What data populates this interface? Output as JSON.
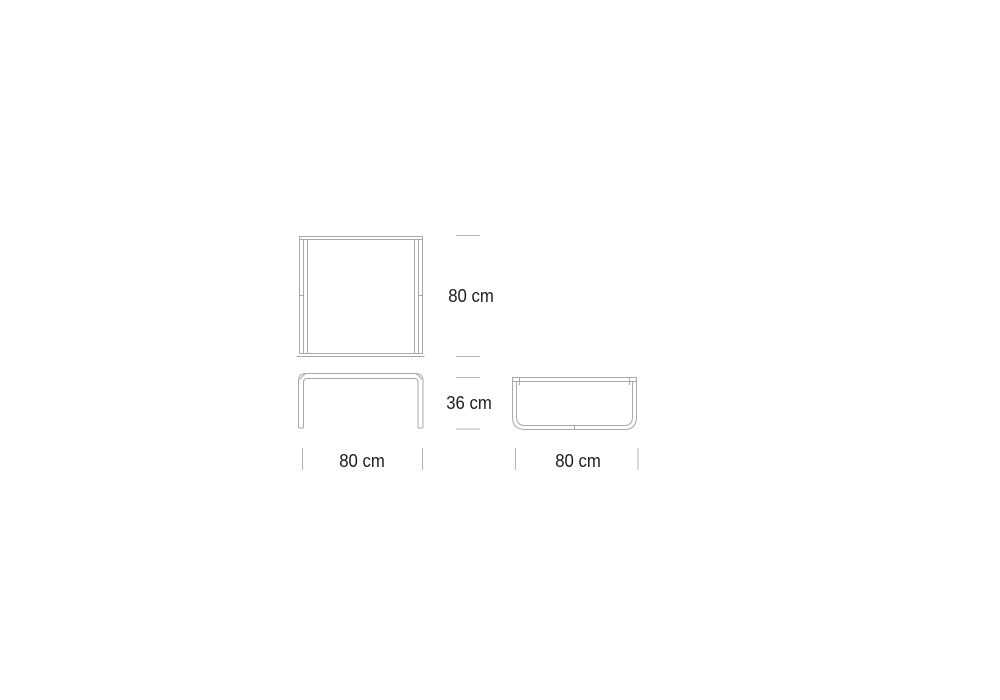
{
  "drawing": {
    "background": "#ffffff",
    "line_color": "#a9a9a9",
    "tick_color": "#b3b3b3",
    "text_color": "#1c1c1c"
  },
  "dimensions": {
    "top_view_depth_label": "80 cm",
    "height_label": "36 cm",
    "front_width_label": "80 cm",
    "side_width_label": "80 cm"
  }
}
